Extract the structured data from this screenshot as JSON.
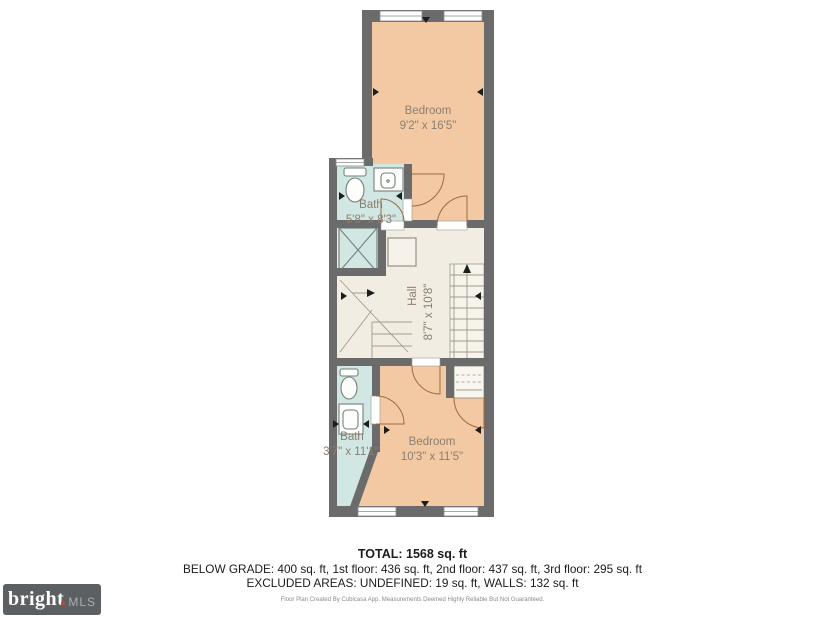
{
  "rooms": {
    "bedroom_top": {
      "name": "Bedroom",
      "dims": "9'2\" x 16'5\""
    },
    "bath_top": {
      "name": "Bath",
      "dims": "5'8\" x 8'3\""
    },
    "hall": {
      "name": "Hall",
      "dims": "8'7\" x 10'8\""
    },
    "bath_bottom": {
      "name": "Bath",
      "dims": "3'7\" x 11'1\""
    },
    "bedroom_bottom": {
      "name": "Bedroom",
      "dims": "10'3\" x 11'5\""
    }
  },
  "summary": {
    "total": "TOTAL: 1568 sq. ft",
    "floors": "BELOW GRADE: 400 sq. ft, 1st floor: 436 sq. ft, 2nd floor: 437 sq. ft, 3rd floor: 295 sq. ft",
    "excluded": "EXCLUDED AREAS: UNDEFINED: 19 sq. ft, WALLS: 132 sq. ft",
    "disclaimer": "Floor Plan Created By Cubicasa App. Measurements Deemed Highly Reliable But Not Guaranteed."
  },
  "logo": {
    "brand": "bright",
    "suffix": "MLS"
  },
  "colors": {
    "wall": "#6b6b6b",
    "bedroom": "#f3c9a3",
    "bath": "#d0e7e3",
    "hall": "#f1ede3",
    "label": "#8c7e71"
  }
}
